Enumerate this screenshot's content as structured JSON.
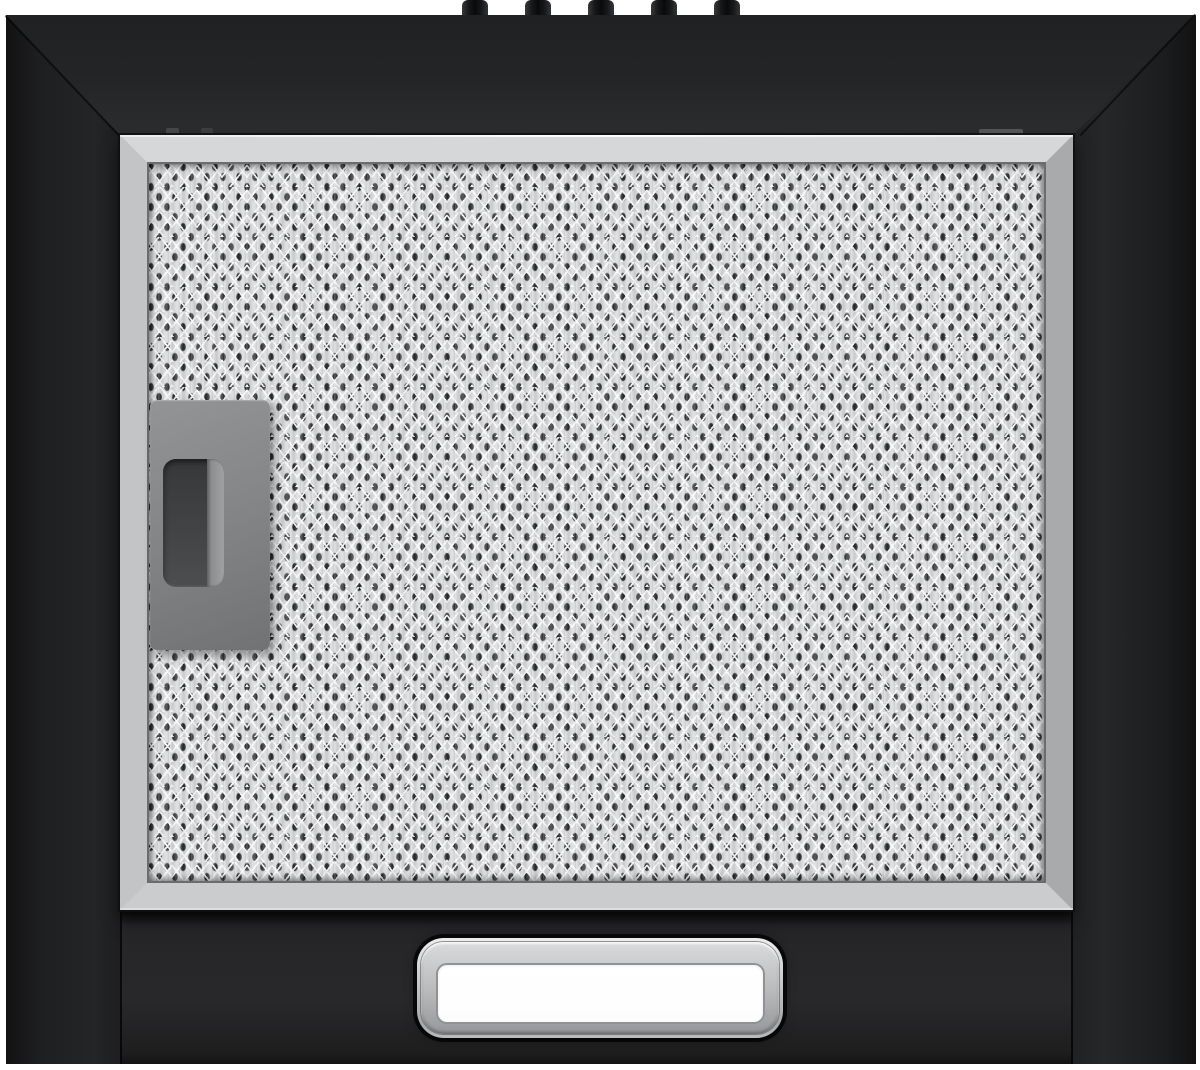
{
  "scene": {
    "type": "product-photo",
    "subject": "black cooker hood seen from the front below, with aluminium mesh grease filter, grey filter release clip and rectangular light diffuser",
    "background_color": "#ffffff"
  },
  "hood": {
    "body_color": "#1e1f20",
    "knobs": {
      "count": 5,
      "centers_x": [
        475,
        538,
        601,
        664,
        727
      ],
      "width": 26,
      "height": 21,
      "color": "#141416"
    },
    "grease_filter": {
      "frame_color": "#c6c7c9",
      "mesh_base_color": "#d7d8da",
      "mesh_hole_color": "#2a2b2d",
      "latch_tabs": [
        {
          "x": 166,
          "y": 128,
          "w": 13,
          "h": 8,
          "color": "#47484a"
        },
        {
          "x": 201,
          "y": 128,
          "w": 12,
          "h": 8,
          "color": "#3d3e40"
        },
        {
          "x": 979,
          "y": 129,
          "w": 44,
          "h": 7,
          "color": "#56575b"
        }
      ]
    },
    "release_clip": {
      "color": "#858688",
      "recess_color": "#3f4042",
      "lip_color": "#9a9b9d"
    },
    "light_panel": {
      "bezel_color": "#b8b9bb",
      "diffuser_color": "#ffffff"
    }
  }
}
